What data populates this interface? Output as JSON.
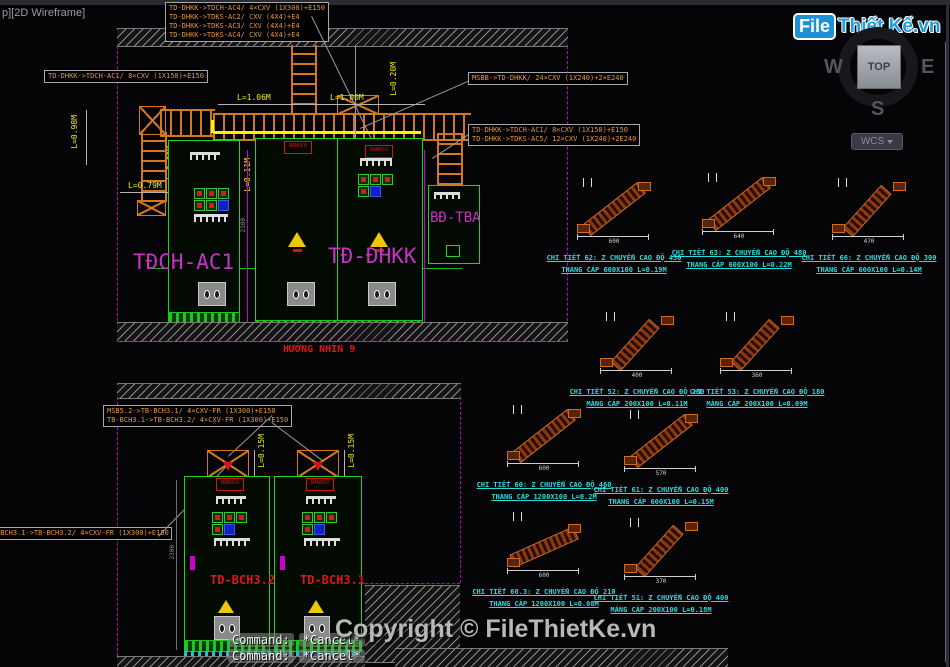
{
  "window": {
    "viewport_label": "p][2D Wireframe]",
    "command_prompt": "Command:",
    "command_value": "*Cancel*",
    "copyright": "Copyright © FileThietKe.vn"
  },
  "logo": {
    "file": "File",
    "rest": "Thiết Kế.vn"
  },
  "viewcube": {
    "west": "W",
    "east": "E",
    "south": "S",
    "top": "TOP",
    "wcs": "WCS"
  },
  "callouts": {
    "top_box": [
      "TD-DHKK->TDCH-AC4/ 4×CXV (1X300)+E150",
      "TD-DHKK->TDKS-AC2/ CXV (4X4)+E4",
      "TD-DHKK->TDKS-AC3/ CXV (4X4)+E4",
      "TD-DHKK->TDKS-AC4/ CXV (4X4)+E4"
    ],
    "left_box": "TD-DHKK->TDCH-AC1/ 8×CXV (1X150)+E150",
    "msbb_box": "MSBB->TD-DHKK/ 24×CXV (1X240)+2×E240",
    "mid_box": [
      "TD-DHKK->TDCH-AC1/ 8×CXV (1X150)+E150",
      "TD-DHKK->TDKS-AC5/ 12×CXV (1X240)+2E240"
    ],
    "bch_box": [
      "MSB5.2->TB-BCH3.1/ 4×CXV-FR (1X300)+E150",
      "TB-BCH3.1->TB-BCH3.2/ 4×CXV-FR (1X300)+E150"
    ],
    "bch_left_box": "-BCH3.1->TB-BCH3.2/ 4×CXV-FR (1X300)+E150"
  },
  "dims1": {
    "h1": "L=1.06M",
    "h2": "L=1.00M",
    "v_left": "L=0.98M",
    "v_left2": "L=0.60M",
    "h3": "L=0.79M",
    "v_mid": "L=0.11M",
    "v_right": "L=0.20M",
    "v_right2": "L=0.20M",
    "side": "2300"
  },
  "drawing1": {
    "cab1": "TĐCH-AC1",
    "cab2": "TĐ-ĐHKK",
    "cab3": "BĐ-TBA",
    "view_label": "HƯỚNG NHÌN 9",
    "nanoco": "NANOCO"
  },
  "drawing2": {
    "cab1": "TD-BCH3.2",
    "cab2": "TD-BCH3.1",
    "nanoco": "NANOCO",
    "dim1": "L=0.15M",
    "dim2": "L=0.15M",
    "side": "2300"
  },
  "details": [
    {
      "title": "CHI TIẾT 62: Z CHUYỂN CAO ĐỘ 430",
      "subtitle": "THANG CÁP 600X100 L=0.19M",
      "base_dim": "600"
    },
    {
      "title": "CHI TIẾT 63: Z CHUYỂN CAO ĐỘ 480",
      "subtitle": "THANG CÁP 600X100 L=0.22M",
      "base_dim": "640"
    },
    {
      "title": "CHI TIẾT 66: Z CHUYỂN CAO ĐỘ 300",
      "subtitle": "THANG CÁP 600X100 L=0.14M",
      "base_dim": "470"
    },
    {
      "title": "CHI TIẾT 52: Z CHUYỂN CAO ĐỘ 230",
      "subtitle": "MÁNG CÁP 200X100 L=0.11M",
      "base_dim": "400"
    },
    {
      "title": "CHI TIẾT 53: Z CHUYỂN CAO ĐỘ 180",
      "subtitle": "MÁNG CÁP 200X100 L=0.09M",
      "base_dim": "360"
    },
    {
      "title": "CHI TIẾT 60: Z CHUYỂN CAO ĐỘ 460",
      "subtitle": "THANG CÁP 1200X100 L=0.2M",
      "base_dim": "600"
    },
    {
      "title": "CHI TIẾT 61: Z CHUYỂN CAO ĐỘ 400",
      "subtitle": "THANG CÁP 600X100 L=0.15M",
      "base_dim": "570"
    },
    {
      "title": "CHI TIẾT 60.3: Z CHUYỂN CAO ĐỘ 210",
      "subtitle": "THANG CÁP 1200X100 L=0.08M",
      "base_dim": "600"
    },
    {
      "title": "CHI TIẾT 51: Z CHUYỂN CAO ĐỘ 400",
      "subtitle": "MÁNG CÁP 200X100 L=0.18M",
      "base_dim": "370"
    }
  ]
}
